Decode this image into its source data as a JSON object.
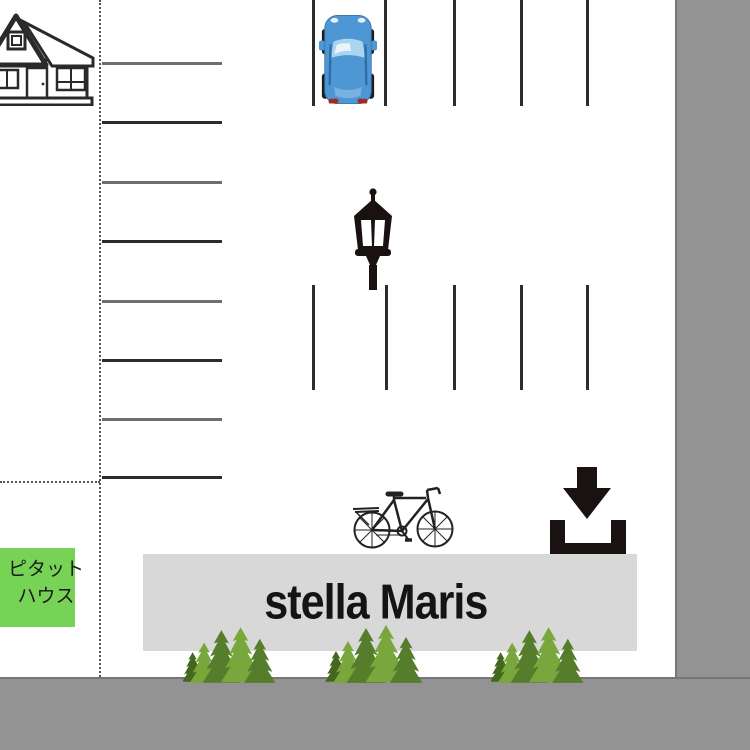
{
  "map": {
    "title": "stella Maris access map",
    "banner": {
      "label": "stella Maris"
    },
    "landmark": {
      "name_line1": "ピタット",
      "name_line2": "ハウス"
    }
  },
  "icons": {
    "house-icon": "black line-art suburban house, top-left, clipped at left edge",
    "car-icon": "blue car seen from above, parked in first top stall",
    "street-lamp-icon": "black classic lantern street lamp",
    "bicycle-icon": "black line-art bicycle facing right",
    "entrance-arrow-icon": "black down arrow into open U bracket (entrance marker)",
    "conifer-trees-icon": "three clusters of green pine trees along banner bottom"
  },
  "parking": {
    "left_row_lines": 8,
    "top_stall_lines": 5,
    "middle_stall_lines": 5
  },
  "colors": {
    "map_bg": "#ffffff",
    "border_gray": "#939393",
    "border_edge": "#767676",
    "banner_bg": "#d8d8d8",
    "banner_text": "#141414",
    "label_green": "#76d356",
    "label_text": "#1a1a1a",
    "line_dark": "#2c2c2c",
    "line_gray": "#6e6e6e",
    "dotted": "#555555",
    "icon_black": "#191210",
    "car_body": "#4e97d5",
    "car_glass": "#abd5ef",
    "tree_dark": "#557d2c",
    "tree_light": "#79a73c",
    "tree_darkest": "#44661f"
  }
}
